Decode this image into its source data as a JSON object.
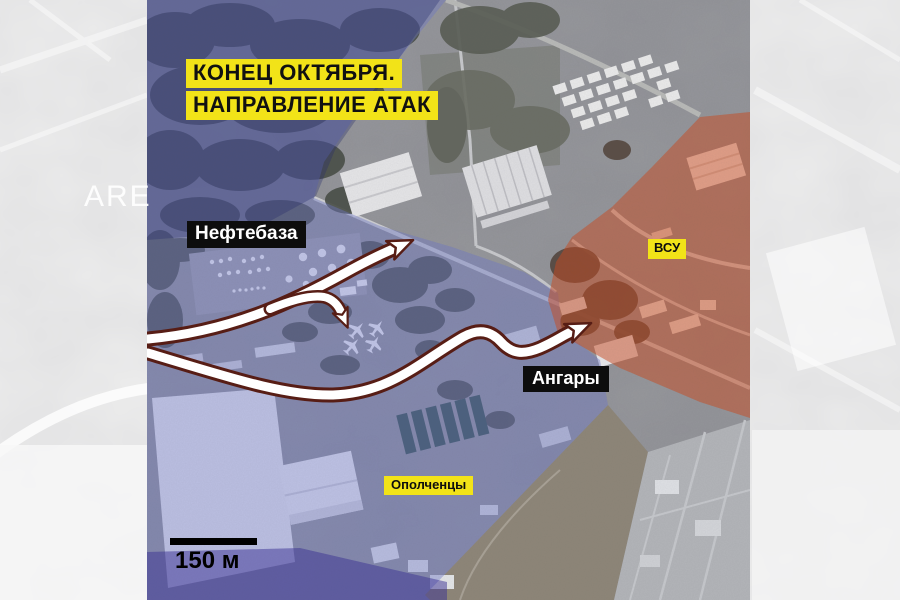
{
  "background": {
    "watermark_text": "ARE"
  },
  "map": {
    "title": {
      "line1": "КОНЕЦ ОКТЯБРЯ.",
      "line2": "НАПРАВЛЕНИЕ АТАК"
    },
    "labels": {
      "oil_depot": "Нефтебаза",
      "ukrainian_forces": "ВСУ",
      "hangars": "Ангары",
      "militia": "Ополченцы"
    },
    "scale_bar": {
      "label": "150 м"
    },
    "zones": {
      "militia_color": "#6d76c9",
      "militia_dark_color": "#252a6e",
      "militia_band_color": "#3a2f96",
      "ukrainian_color": "#cc4a1e",
      "highlight_yellow": "#f2e318",
      "arrow_outline": "#571d15",
      "arrow_fill": "#ffffff"
    }
  }
}
